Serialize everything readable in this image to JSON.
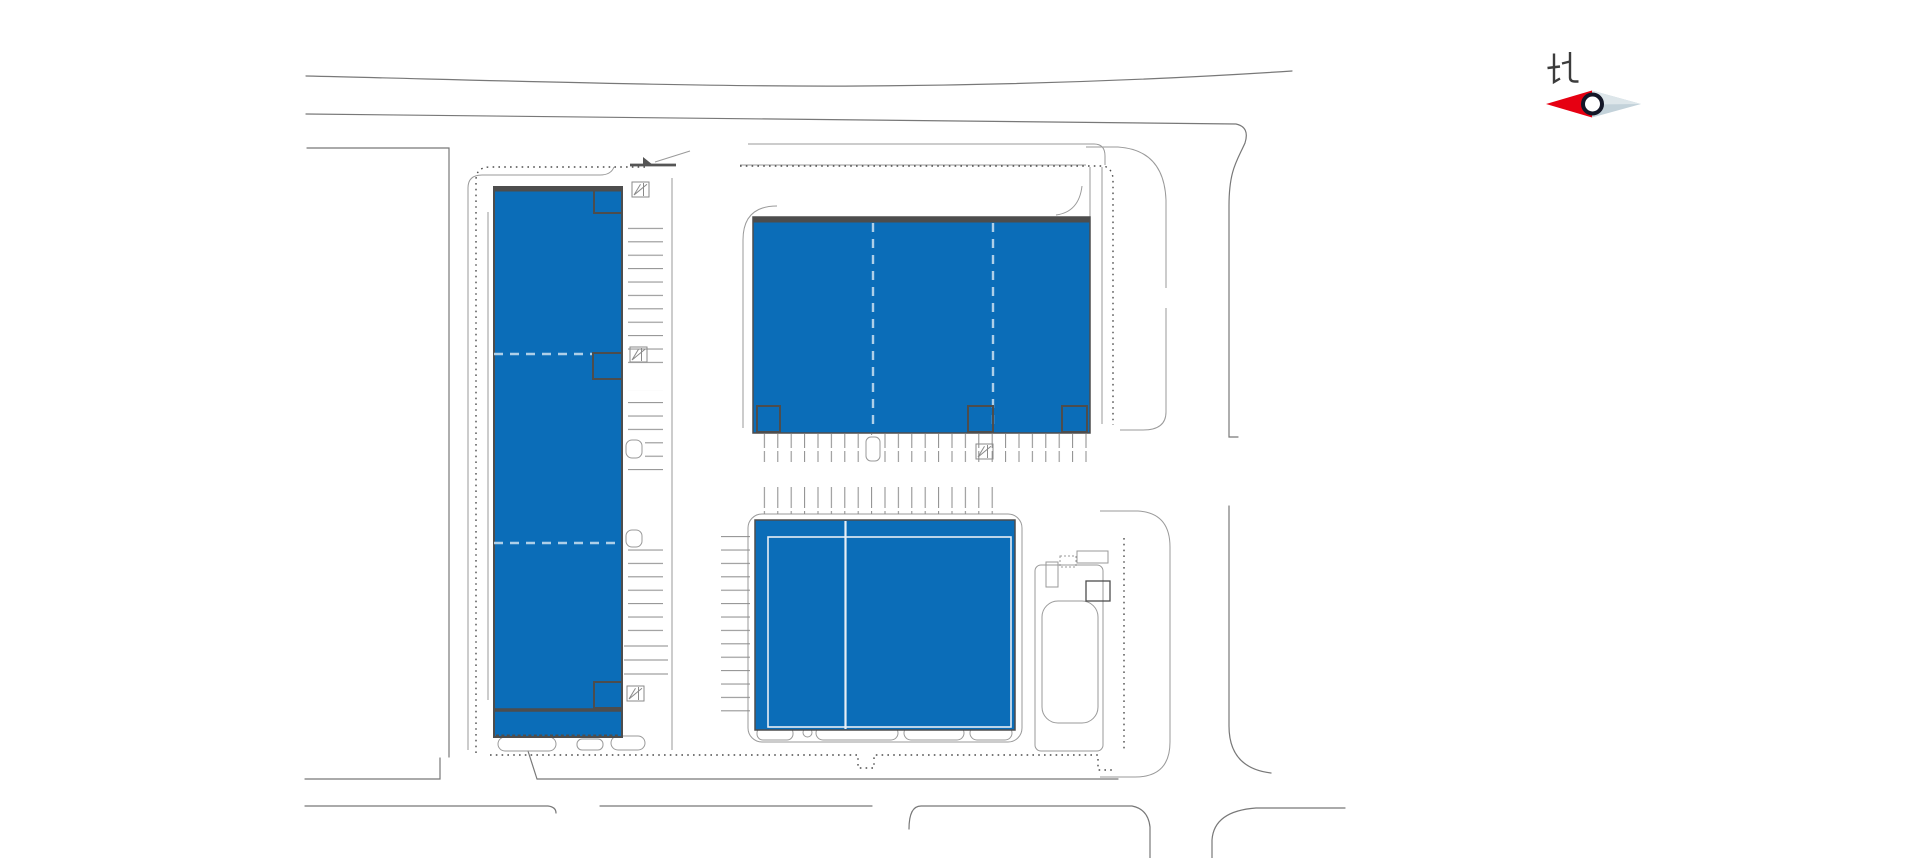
{
  "compass": {
    "label": "北"
  },
  "buildings": [
    {
      "name": "west-building"
    },
    {
      "name": "northeast-building"
    },
    {
      "name": "southeast-building"
    }
  ],
  "colors": {
    "background": "#ffffff",
    "building_fill": "#0b6db8",
    "building_border": "#4d4d4d",
    "road_line": "#787878",
    "curb_line": "#9a9a9a",
    "property_line": "#4d4d4d",
    "parking_line": "#8a8a8a",
    "divider_dash": "#aecfe8",
    "inner_white_line": "#e7eef5",
    "compass_red": "#e60012",
    "compass_blade": "#c3d2da",
    "compass_blade_light": "#dde6ea",
    "compass_ring": "#141728",
    "compass_text": "#3c3c3c"
  }
}
